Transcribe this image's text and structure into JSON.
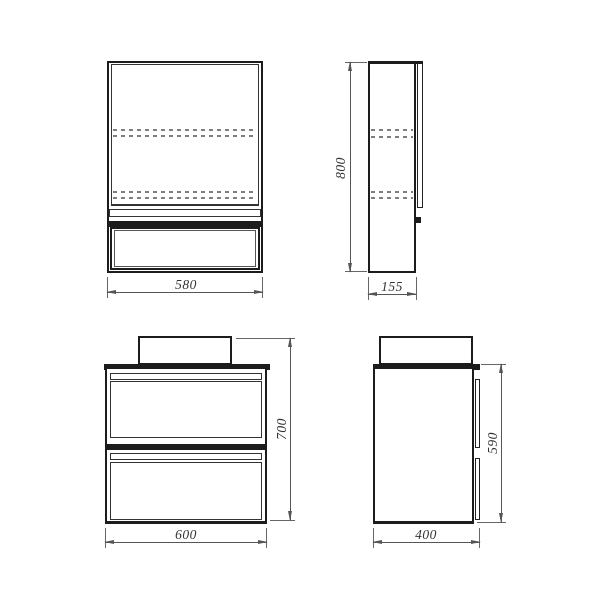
{
  "drawing": {
    "title": "bathroom-furniture-technical-drawing",
    "views": {
      "mirror_front": "mirror-cabinet-front-view",
      "mirror_side": "mirror-cabinet-side-view",
      "vanity_front": "vanity-cabinet-front-view",
      "vanity_side": "vanity-cabinet-side-view"
    },
    "dimensions": {
      "mirror_width": "580",
      "mirror_height": "800",
      "mirror_depth": "155",
      "vanity_width": "600",
      "vanity_height": "700",
      "vanity_body_height": "590",
      "vanity_depth": "400"
    },
    "colors": {
      "outline": "#1c1c1c",
      "dimension_line": "#555555",
      "dashed_shelf_line": "#7d7d7d",
      "text": "#333333",
      "background": "#ffffff"
    }
  }
}
